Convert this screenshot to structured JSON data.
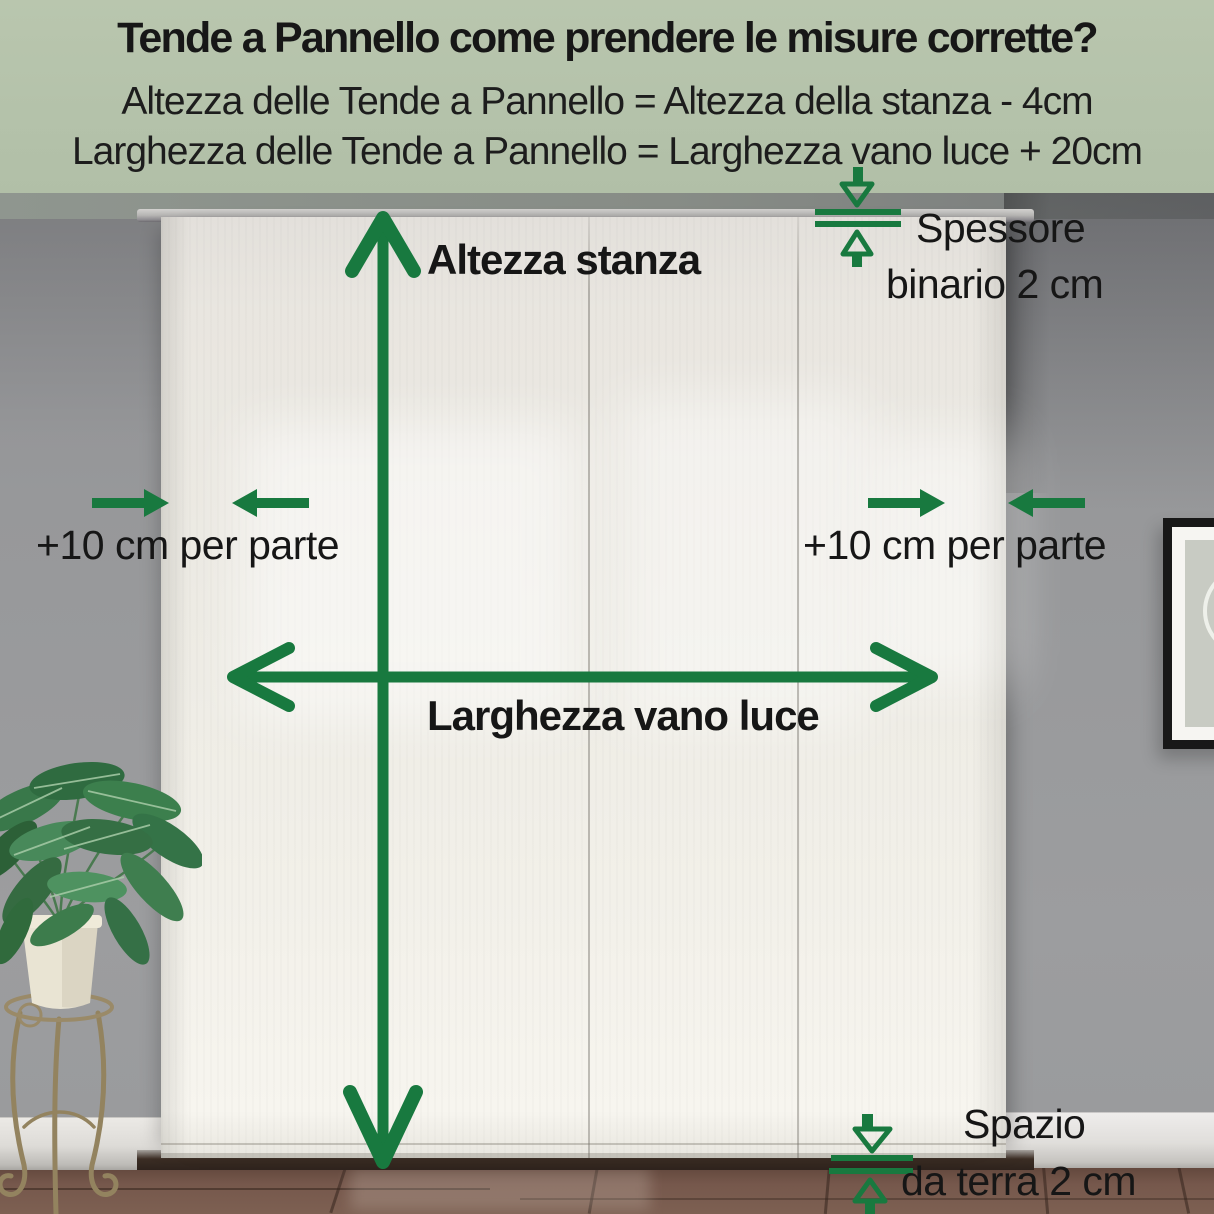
{
  "header": {
    "title": "Tende a Pannello come prendere le misure corrette?",
    "formula_height": "Altezza delle Tende a Pannello = Altezza della stanza - 4cm",
    "formula_width": "Larghezza delle Tende a Pannello = Larghezza vano luce + 20cm"
  },
  "labels": {
    "room_height": "Altezza stanza",
    "opening_width": "Larghezza vano luce",
    "extension_left": "+10 cm per parte",
    "extension_right": "+10 cm per parte",
    "rail_thickness_line1": "Spessore",
    "rail_thickness_line2": "binario 2 cm",
    "floor_gap_line1": "Spazio",
    "floor_gap_line2": "da terra 2 cm"
  },
  "colors": {
    "header_background": "#b4c2aa",
    "arrow_green": "#18793f",
    "header_text": "#1b1b1b",
    "label_text": "#161616",
    "wall_gray": "#97989a",
    "curtain_white": "#efece6",
    "floor_brown": "#76584c"
  }
}
